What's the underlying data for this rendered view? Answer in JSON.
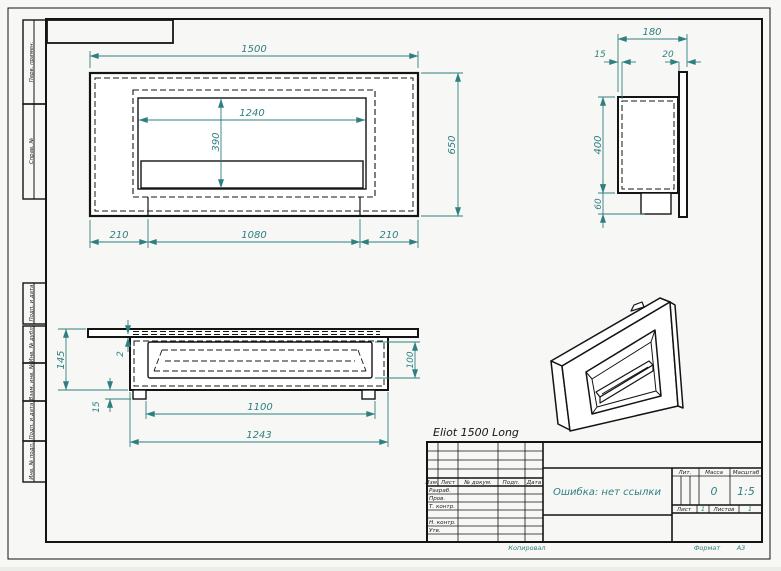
{
  "drawing": {
    "product_name": "Eliot 1500 Long",
    "doc_title": "Ошибка: нет ссылки",
    "mass_value": "0",
    "scale_value": "1:5",
    "sheet_value": "1",
    "sheets_value": "1",
    "format_value": "A3"
  },
  "views": {
    "front": {
      "width": "1500",
      "height": "650",
      "opening_width": "1240",
      "opening_height": "390",
      "left_offset": "210",
      "niche_width": "1080",
      "right_offset": "210"
    },
    "side": {
      "depth": "180",
      "gap_left": "15",
      "gap_right": "20",
      "body_height": "400",
      "burner_height": "60"
    },
    "plan": {
      "total_height": "145",
      "plate_thickness": "2",
      "foot_height": "15",
      "tray_depth": "100",
      "feet_span": "1100",
      "body_width": "1243"
    }
  },
  "title_block": {
    "col_izm": "Изм.",
    "col_list": "Лист",
    "col_doc": "№ докум.",
    "col_podp": "Подп.",
    "col_data": "Дата",
    "row_razrab": "Разраб.",
    "row_prov": "Пров.",
    "row_tkontr": "Т. контр.",
    "row_nkontr": "Н. контр.",
    "row_utv": "Утв.",
    "lit_label": "Лит.",
    "mass_label": "Масса",
    "scale_label": "Масштаб",
    "sheet_label": "Лист",
    "sheets_label": "Листов",
    "kopiroval_label": "Копировал",
    "format_label": "Формат"
  },
  "margin_labels": {
    "perv_primen": "Перв. примен.",
    "sprav_no": "Справ. №",
    "podp_data_1": "Подп. и дата",
    "inv_dubl": "Инв. № дубл.",
    "vzam_inv": "Взам. инв. №",
    "podp_data_2": "Подп. и дата",
    "inv_podl": "Инв. № подл."
  },
  "colors": {
    "dimension": "#2e7f7f",
    "object_line": "#141414",
    "sheet": "#ffffff"
  }
}
